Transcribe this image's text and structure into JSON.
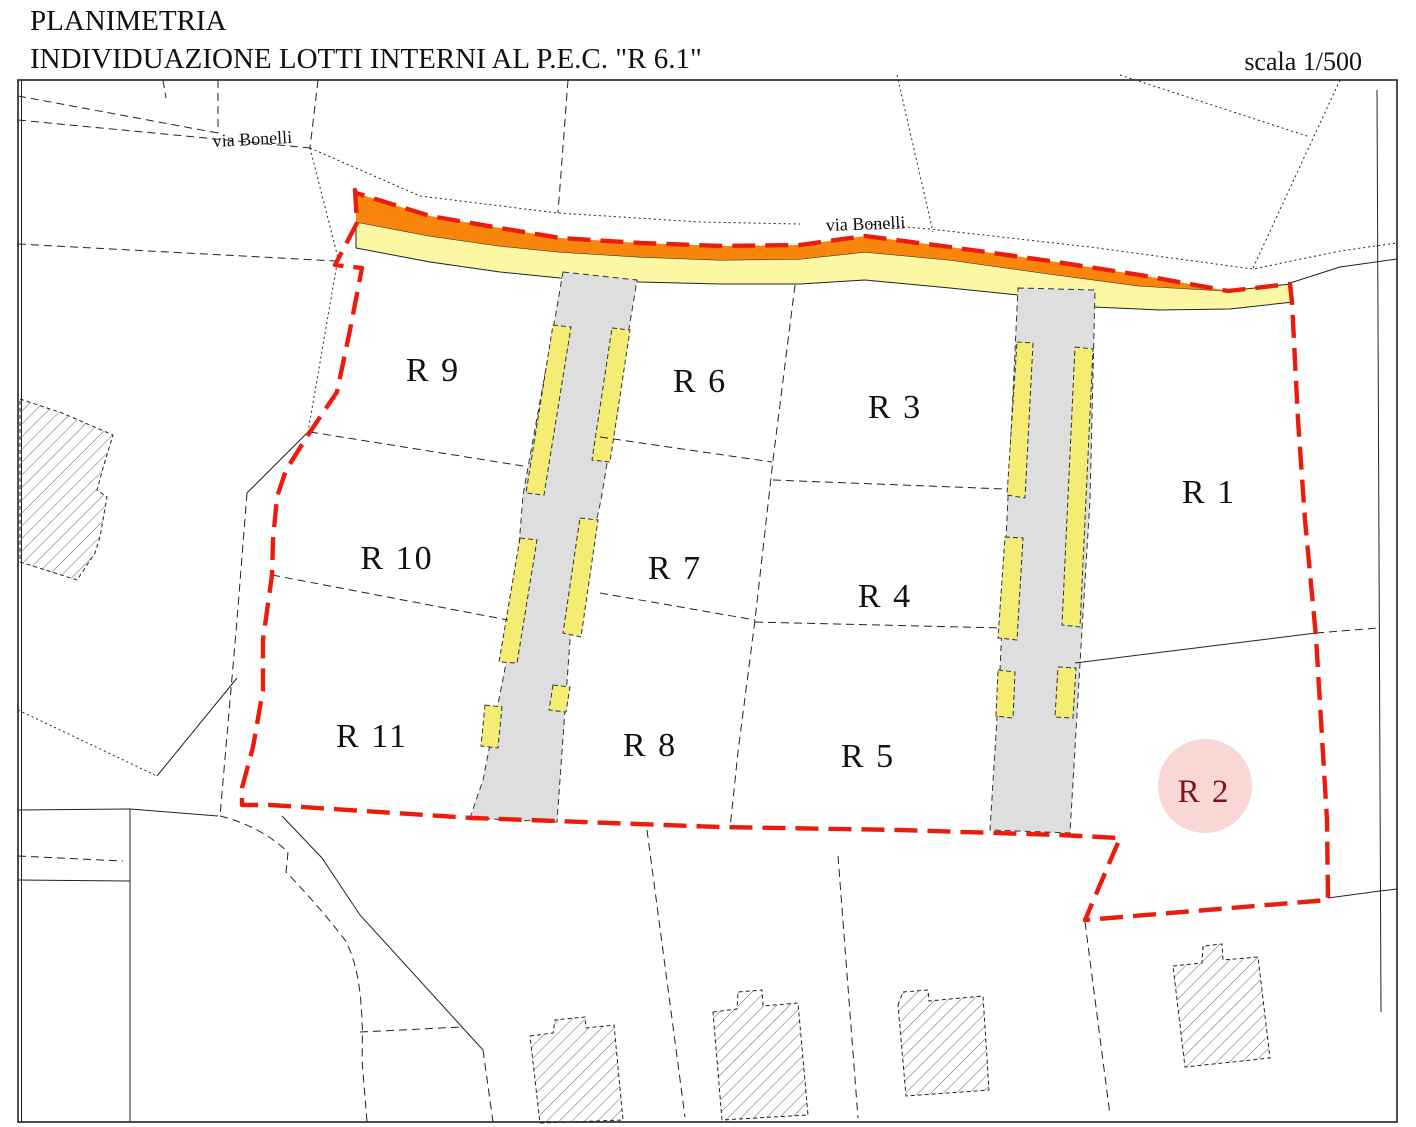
{
  "header": {
    "title_line1": "PLANIMETRIA",
    "title_line2": "INDIVIDUAZIONE LOTTI INTERNI AL P.E.C. \"R 6.1\"",
    "scale_label": "scala 1/500"
  },
  "street_labels": {
    "label1": "via Bonelli",
    "label2": "via Bonelli"
  },
  "lots": [
    {
      "label": "R 1"
    },
    {
      "label": "R 2"
    },
    {
      "label": "R 3"
    },
    {
      "label": "R 4"
    },
    {
      "label": "R 5"
    },
    {
      "label": "R 6"
    },
    {
      "label": "R 7"
    },
    {
      "label": "R 8"
    },
    {
      "label": "R 9"
    },
    {
      "label": "R 10"
    },
    {
      "label": "R 11"
    }
  ],
  "highlight": {
    "lot": "R 2",
    "circle_color": "#f8d7d5",
    "text_color": "#7a1511"
  },
  "legend_colors": {
    "pec_boundary_red": "#ec1c0c",
    "road_widening_orange": "#f8860d",
    "sidewalk_yellow": "#fcf7a3",
    "parking_yellow": "#f5ec74",
    "internal_road_gray": "#dedede"
  }
}
